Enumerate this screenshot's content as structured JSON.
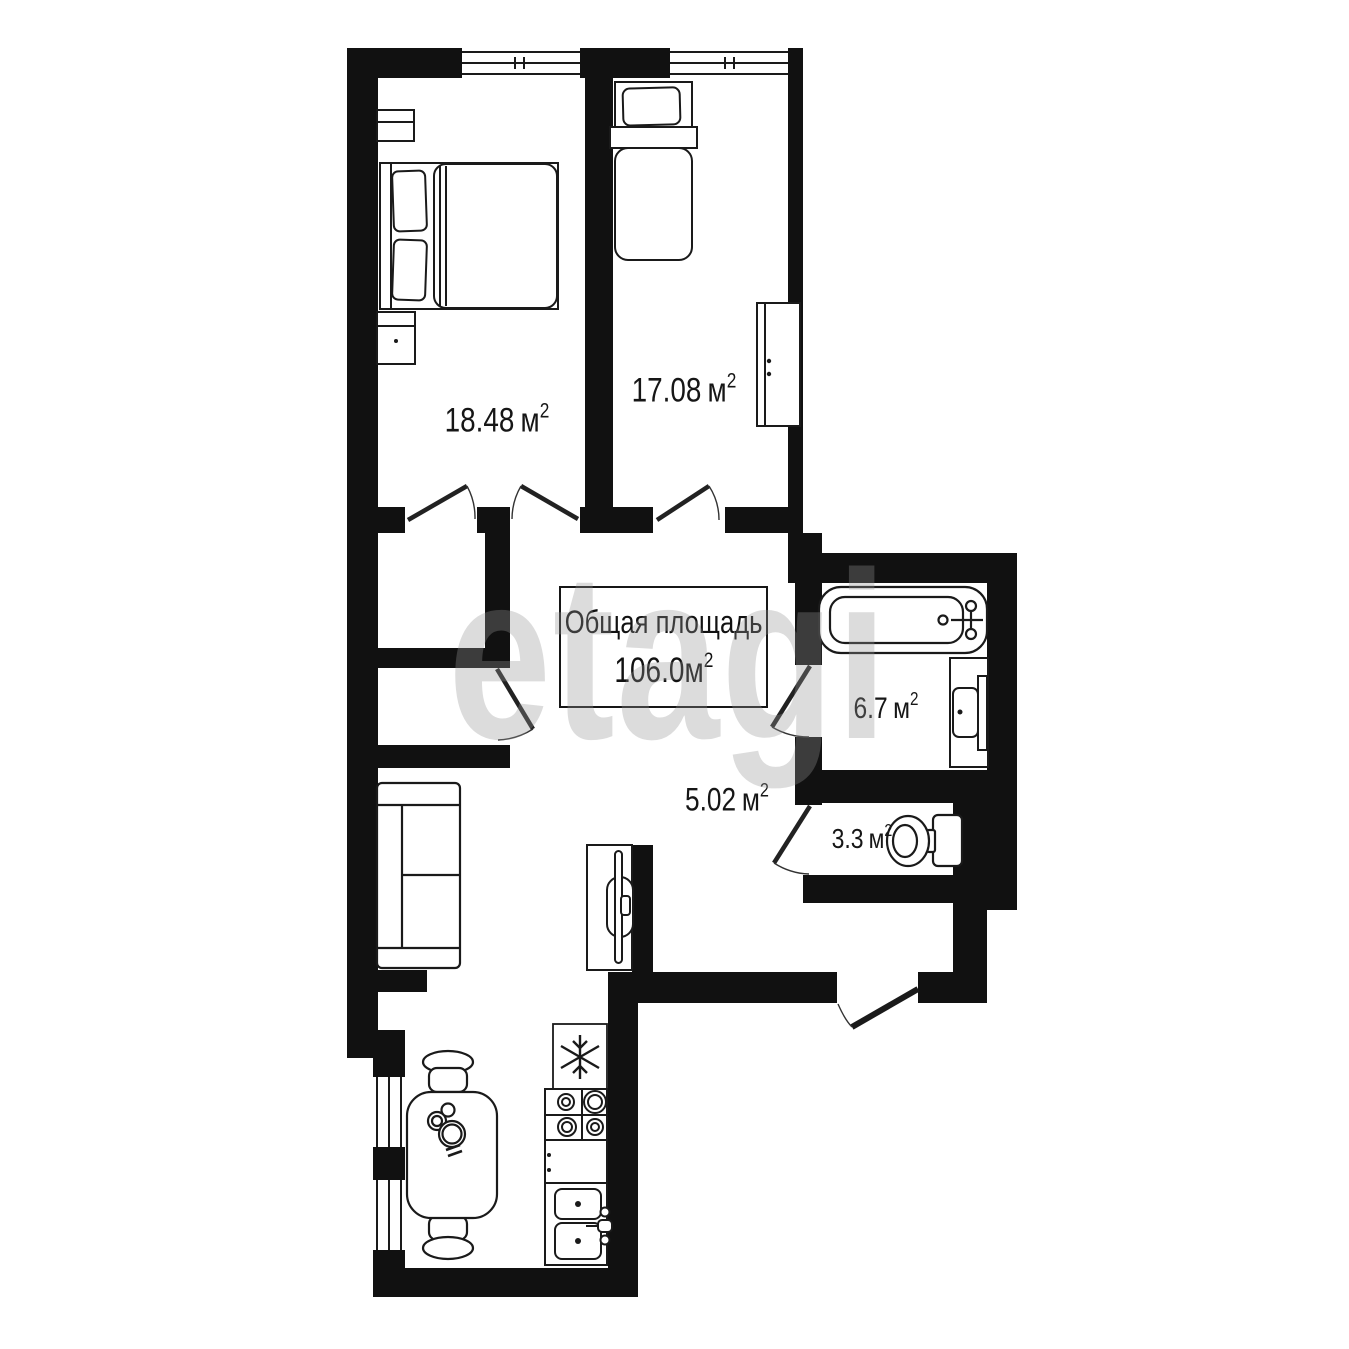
{
  "plan": {
    "watermark": "etagi",
    "total": {
      "label": "Общая площадь",
      "value": "106.0",
      "unit": "м",
      "sup": "2"
    },
    "rooms": [
      {
        "id": "bedroom-1",
        "value": "18.48",
        "unit": "м",
        "sup": "2"
      },
      {
        "id": "bedroom-2",
        "value": "17.08",
        "unit": "м",
        "sup": "2"
      },
      {
        "id": "bathroom",
        "value": "6.7",
        "unit": "м",
        "sup": "2"
      },
      {
        "id": "hallway",
        "value": "5.02",
        "unit": "м",
        "sup": "2"
      },
      {
        "id": "wc",
        "value": "3.3",
        "unit": "м",
        "sup": "2"
      }
    ],
    "icons": {
      "fridge": "snowflake-icon"
    },
    "colors": {
      "wall": "#111111",
      "line": "#1a1a1a",
      "background": "#ffffff"
    }
  }
}
